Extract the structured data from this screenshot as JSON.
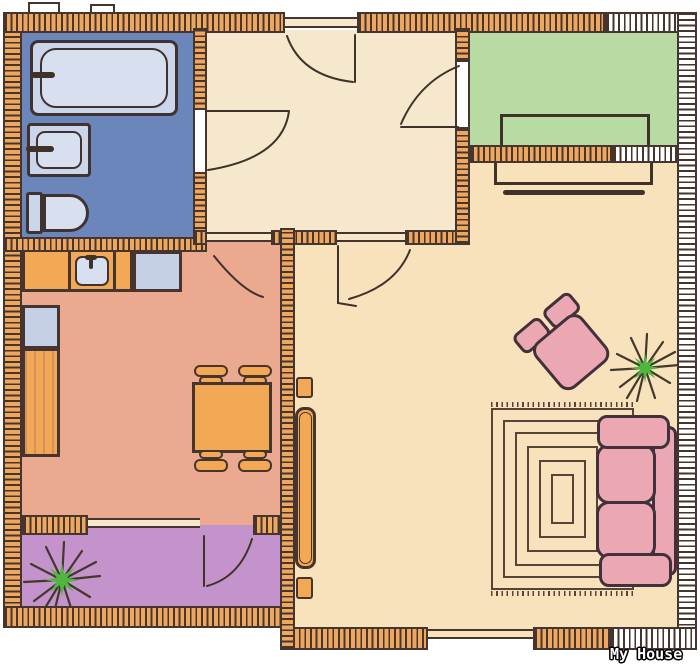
{
  "title": {
    "label": "My House"
  },
  "palette": {
    "wall_line": "#46352f",
    "wall_brick": "#eda75f",
    "hall_floor": "#f6e8cc",
    "living_floor": "#f8e2bb",
    "kitchen_floor": "#eba98f",
    "bathroom_floor": "#6b86ba",
    "green_balcony_floor": "#b8dba4",
    "purple_balcony_floor": "#c493cc",
    "fixture_blue": "#ccd6ea",
    "fixture_blue_light": "#d8dfef",
    "counter_orange": "#f2a854",
    "counter_blue": "#c5cfe6",
    "sofa_pink": "#eba8b2",
    "sofa_line": "#42303a",
    "plant_green": "#4eb83e",
    "rug_line": "#564438",
    "label_text": "#ffffff"
  },
  "rooms": [
    {
      "name": "bathroom",
      "floor_color_key": "bathroom_floor",
      "fixtures": [
        "bathtub",
        "wash-basin",
        "toilet"
      ]
    },
    {
      "name": "hallway",
      "floor_color_key": "hall_floor",
      "fixtures": []
    },
    {
      "name": "green-balcony",
      "floor_color_key": "green_balcony_floor",
      "fixtures": [
        "bench"
      ]
    },
    {
      "name": "kitchen",
      "floor_color_key": "kitchen_floor",
      "fixtures": [
        "counter-with-sink",
        "blue-counter",
        "dining-table",
        "four-chairs"
      ]
    },
    {
      "name": "living-room",
      "floor_color_key": "living_floor",
      "fixtures": [
        "sofa",
        "armchair",
        "spiral-rug",
        "tv-unit",
        "window-sideboard",
        "plant"
      ]
    },
    {
      "name": "purple-balcony",
      "floor_color_key": "purple_balcony_floor",
      "fixtures": [
        "plant"
      ]
    }
  ],
  "doors": [
    "entry-door",
    "bathroom-door",
    "green-balcony-door",
    "kitchen-door",
    "living-room-door",
    "purple-balcony-door"
  ]
}
